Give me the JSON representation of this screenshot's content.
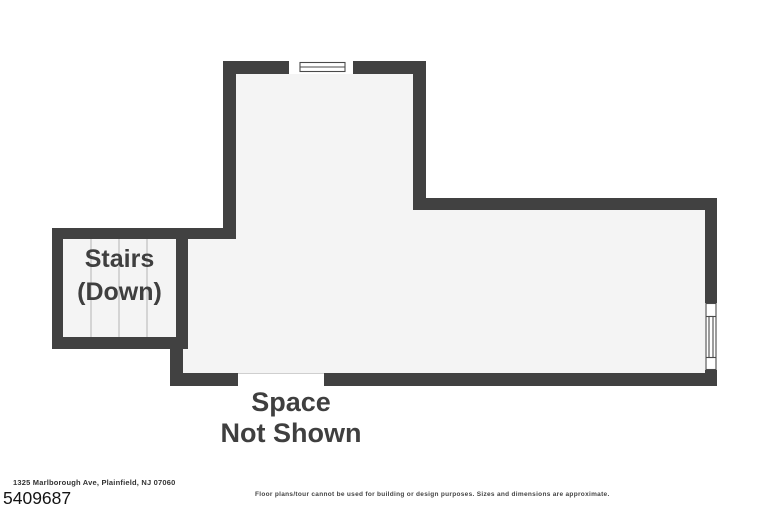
{
  "plan": {
    "stairs_label": [
      "Stairs",
      "(Down)"
    ],
    "space_label": [
      "Space",
      "Not Shown"
    ],
    "colors": {
      "wall": "#414141",
      "floor": "#f4f4f4",
      "stair_tread": "#c9c9c9",
      "window_stroke": "#4a4a4a",
      "opening_edge": "#cfcfcf",
      "background": "#ffffff",
      "label_text": "#3f3f3f"
    }
  },
  "footer": {
    "address": "1325 Marlborough Ave, Plainfield, NJ 07060",
    "listing_id": "5409687",
    "disclaimer": "Floor plans/tour cannot be used for building or design purposes. Sizes and dimensions are approximate."
  }
}
